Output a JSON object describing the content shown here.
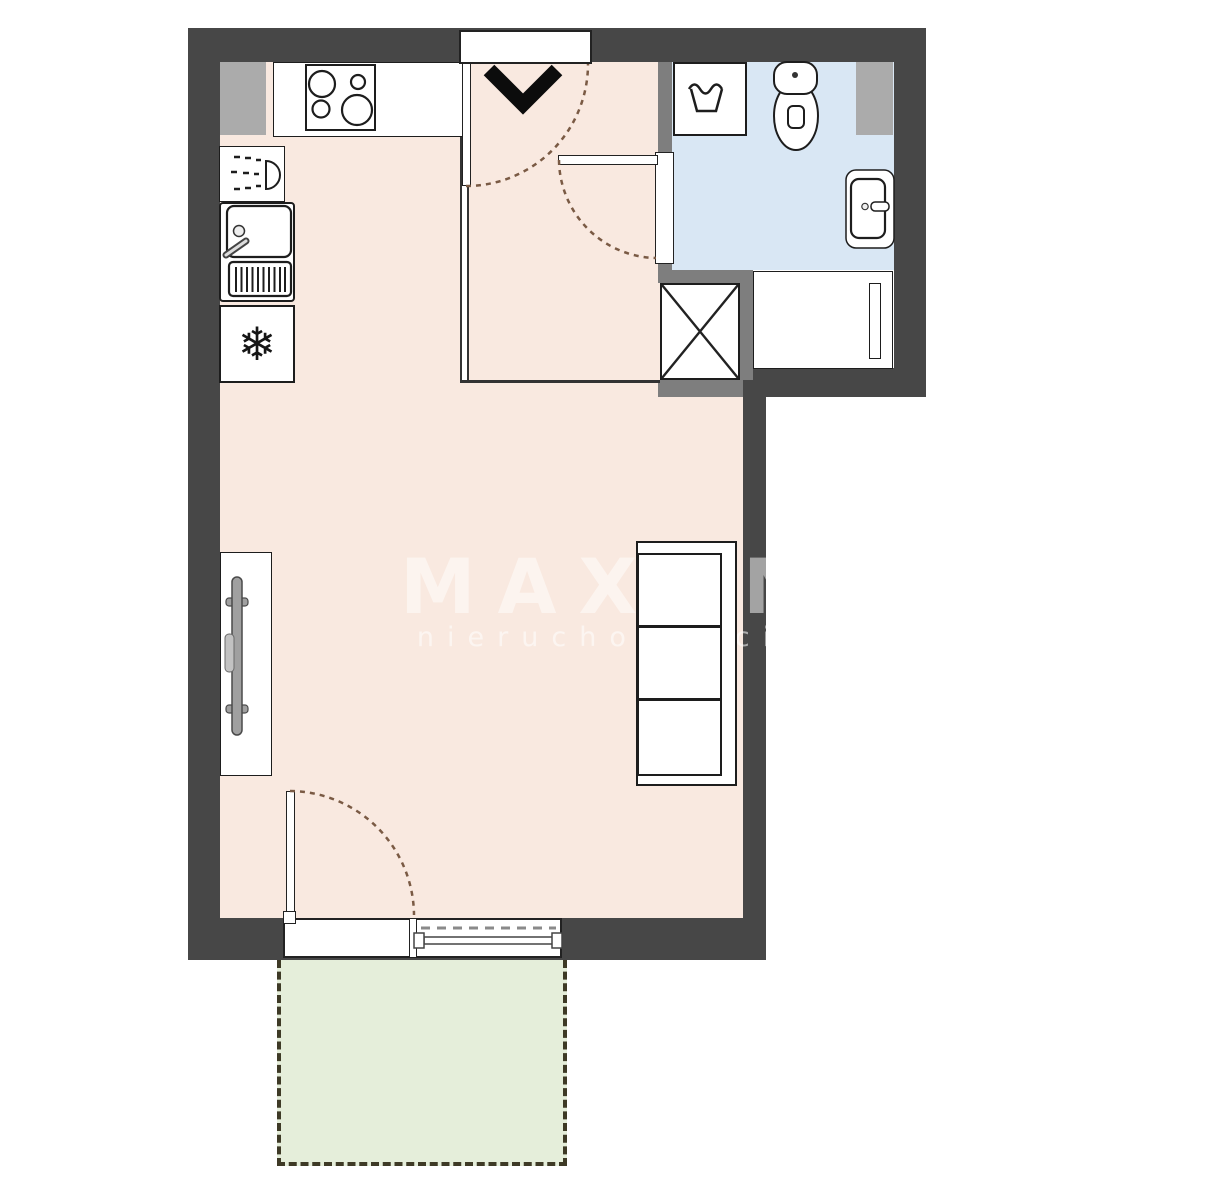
{
  "watermark": {
    "line1": "MAXON",
    "line2": "nieruchomości"
  },
  "icons": {
    "fridge_snowflake": "❄"
  },
  "colors": {
    "outer-wall": "#474747",
    "partition-wall": "#7e7e7e",
    "floor-main": "#f9e9e0",
    "floor-bath": "#d9e7f4",
    "floor-balcony": "#e5eeda",
    "wall-block": "#ababab",
    "stroke": "#1d1d1d",
    "door-arc": "#7a5a44",
    "balcony-edge": "#3e3a26",
    "watermark": "#ffffff"
  }
}
